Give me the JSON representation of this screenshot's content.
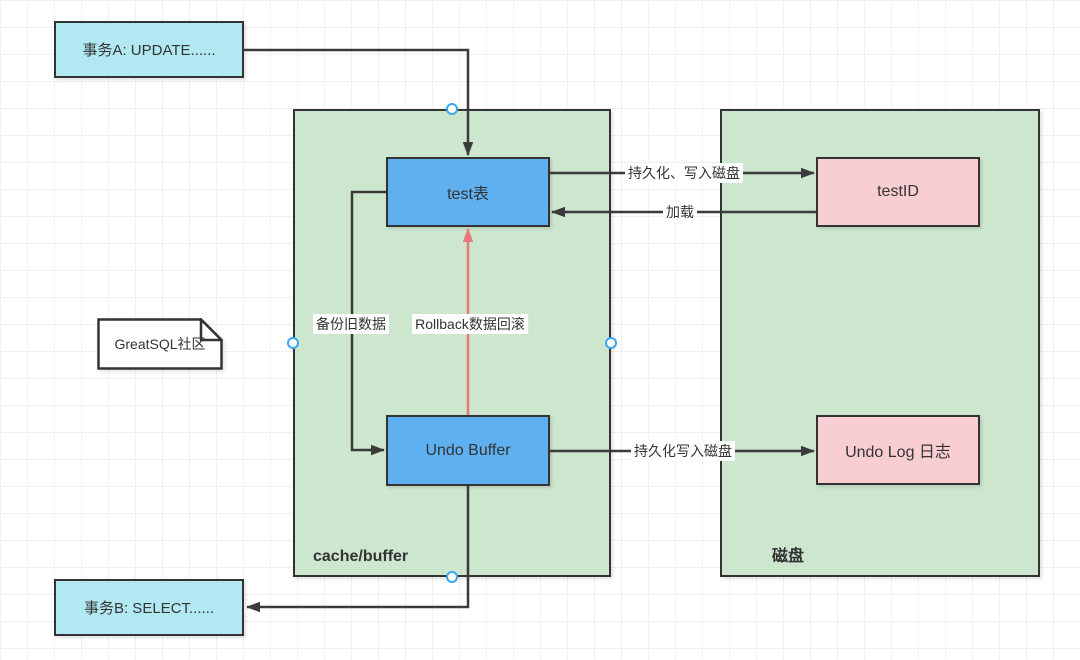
{
  "colors": {
    "cyan_fill": "#b2e8f1",
    "blue_fill": "#5fb0f0",
    "green_fill": "#cde6ce",
    "pink_fill": "#f9ced3",
    "node_border": "#333333",
    "edge_color": "#3b3b3b",
    "red_edge": "#e8797b",
    "conn_point": "#3aa7f0",
    "text": "#333333",
    "grid_line": "#f0f0f0"
  },
  "shapes": {
    "transaction_a": {
      "label": "事务A: UPDATE......"
    },
    "transaction_b": {
      "label": "事务B: SELECT......"
    },
    "note": {
      "label": "GreatSQL社区"
    },
    "cache_container": {
      "label": "cache/buffer"
    },
    "disk_container": {
      "label": "磁盘"
    },
    "test_table": {
      "label": "test表"
    },
    "undo_buffer": {
      "label": "Undo Buffer"
    },
    "test_id": {
      "label": "testID"
    },
    "undo_log": {
      "label": "Undo Log 日志"
    }
  },
  "edge_labels": {
    "persist_write": "持久化、写入磁盘",
    "load": "加载",
    "backup_old_data": "备份旧数据",
    "rollback": "Rollback数据回滚",
    "persist_write_disk": "持久化写入磁盘"
  }
}
